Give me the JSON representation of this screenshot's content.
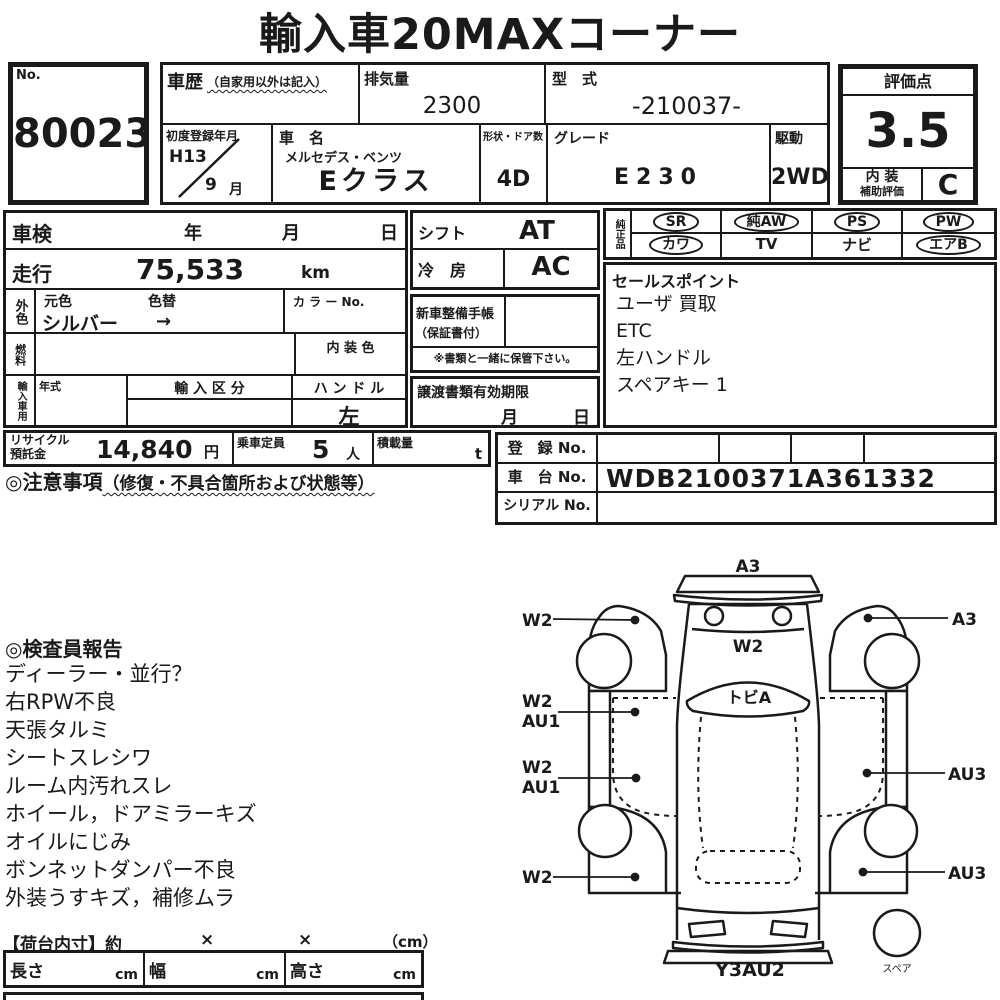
{
  "title": "輸入車20MAXコーナー",
  "no_box": {
    "label": "No.",
    "value": "80023"
  },
  "top": {
    "history_label": "車歴",
    "history_note": "（自家用以外は記入）",
    "displacement_label": "排気量",
    "displacement_value": "2300",
    "model_code_label": "型　式",
    "model_code_value": "-210037-",
    "first_reg_label": "初度登録年月",
    "first_reg_year": "H13",
    "first_reg_month": "9",
    "first_reg_month_suffix": "月",
    "name_label": "車　名",
    "maker": "メルセデス・ベンツ",
    "model": "Eクラス",
    "doors_label": "形状・ドア数",
    "doors_value": "4D",
    "grade_label": "グレード",
    "grade_value": "E230",
    "drive_label": "駆動",
    "drive_value": "2WD"
  },
  "rating": {
    "header": "評価点",
    "score": "3.5",
    "interior_line1": "内 装",
    "interior_line2": "補助評価",
    "interior_grade": "C"
  },
  "left": {
    "shaken_label": "車検",
    "year": "年",
    "month": "月",
    "day": "日",
    "mileage_label": "走行",
    "mileage_value": "75,533",
    "mileage_unit": "km",
    "ext_color_label": "外色",
    "orig_color_label": "元色",
    "repaint_label": "色替",
    "color_value": "シルバー",
    "color_arrow": "→",
    "color_no_label": "カ ラ ー No.",
    "fuel_label": "燃料",
    "interior_color_label": "内 装 色",
    "import_label": "輸入車用",
    "year_type_label": "年式",
    "import_class_label": "輸 入 区 分",
    "steering_label": "ハ ン ド ル",
    "steering_value": "左"
  },
  "mid": {
    "shift_label": "シフト",
    "shift_value": "AT",
    "ac_label": "冷　房",
    "ac_value": "AC",
    "service_book_line1": "新車整備手帳",
    "service_book_line2": "（保証書付）",
    "keep_note": "※書類と一緒に保管下さい。",
    "transfer_label": "譲渡書類有効期限",
    "transfer_month": "月",
    "transfer_day": "日"
  },
  "oem": {
    "label": "純正品",
    "row1": [
      {
        "text": "SR",
        "circled": true
      },
      {
        "text": "純AW",
        "circled": true
      },
      {
        "text": "PS",
        "circled": true
      },
      {
        "text": "PW",
        "circled": true
      }
    ],
    "row2": [
      {
        "text": "カワ",
        "circled": true
      },
      {
        "text": "TV",
        "circled": false
      },
      {
        "text": "ナビ",
        "circled": false
      },
      {
        "text": "エアB",
        "circled": true
      }
    ]
  },
  "sales": {
    "header": "セールスポイント",
    "items": [
      "ユーザ 買取",
      "ETC",
      "左ハンドル",
      "スペアキー 1"
    ]
  },
  "recycle": {
    "label_line1": "リサイクル",
    "label_line2": "預託金",
    "value": "14,840",
    "unit": "円"
  },
  "capacity": {
    "label": "乗車定員",
    "value": "5",
    "unit": "人"
  },
  "load": {
    "label": "積載量",
    "unit": "t"
  },
  "reg": {
    "reg_label": "登　録 No.",
    "chassis_label": "車　台 No.",
    "chassis_value": "WDB2100371A361332",
    "serial_label": "シリアル No."
  },
  "caution": {
    "header": "◎注意事項",
    "note": "（修復・不具合箇所および状態等）"
  },
  "inspector": {
    "header": "◎検査員報告",
    "items": [
      "ディーラー・並行？",
      "右RPW不良",
      "天張タルミ",
      "シートスレシワ",
      "ルーム内汚れスレ",
      "ホイール，ドアミラーキズ",
      "オイルにじみ",
      "ボンネットダンパー不良",
      "外装うすキズ，補修ムラ"
    ]
  },
  "diagram": {
    "front": "A3",
    "left_top": "W2",
    "right_top": "A3",
    "hood": "W2",
    "windshield": "トビA",
    "left_mid1_l1": "W2",
    "left_mid1_l2": "AU1",
    "left_mid2_l1": "W2",
    "left_mid2_l2": "AU1",
    "right_mid": "AU3",
    "left_bottom": "W2",
    "right_bottom": "AU3",
    "rear": "Y3AU2",
    "spare": "スペア"
  },
  "cargo": {
    "header": "【荷台内寸】約",
    "times1": "×",
    "times2": "×",
    "unit": "（cm）",
    "cols": [
      {
        "label": "長さ",
        "unit": "cm"
      },
      {
        "label": "幅",
        "unit": "cm"
      },
      {
        "label": "高さ",
        "unit": "cm"
      }
    ]
  },
  "ink": "#1a1a1a"
}
